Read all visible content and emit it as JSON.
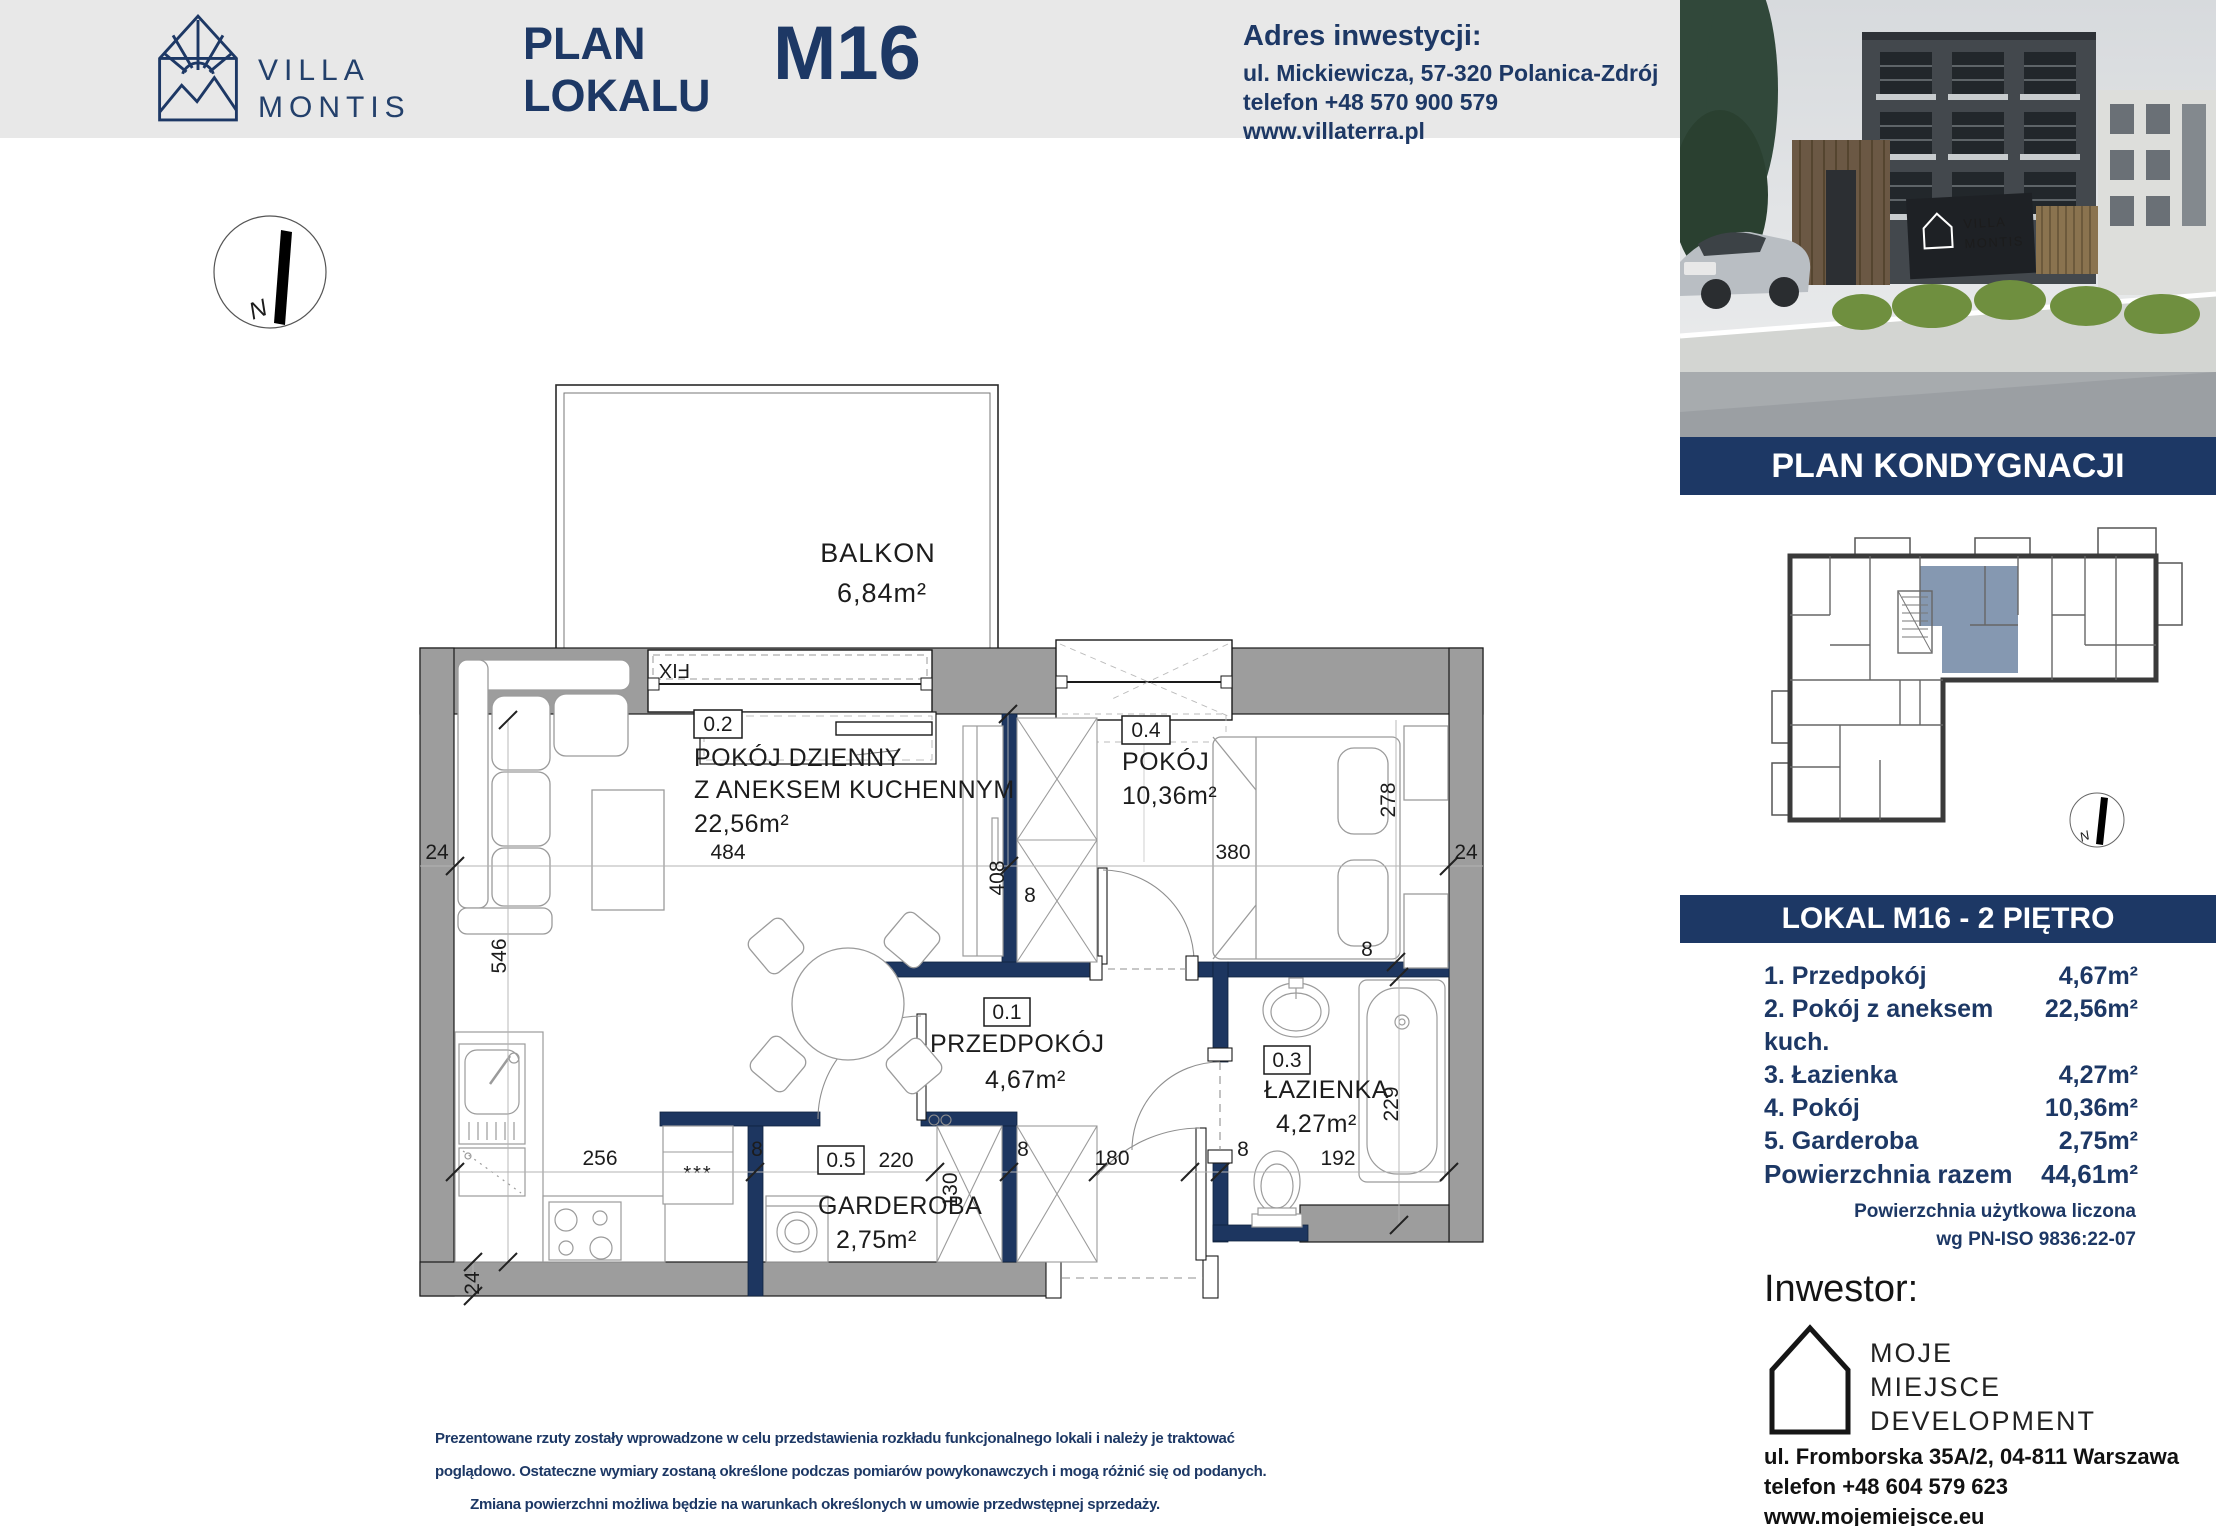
{
  "colors": {
    "navy": "#1d3865",
    "wall_gray": "#9d9d9d",
    "unit_highlight": "#8598b1"
  },
  "header": {
    "brand_line1": "VILLA",
    "brand_line2": "MONTIS",
    "title_line1": "PLAN",
    "title_line2": "LOKALU",
    "unit_code": "M16",
    "address_heading": "Adres inwestycji:",
    "address_street": "ul. Mickiewicza, 57-320 Polanica-Zdrój",
    "address_phone": "telefon +48 570 900 579",
    "address_web": "www.villaterra.pl"
  },
  "plan": {
    "compass_label": "N",
    "balcony_name": "BALKON",
    "balcony_area": "6,84m²",
    "window_fix": "FIX",
    "fridge_mark": "***",
    "rooms": {
      "living": {
        "id": "0.2",
        "line1": "POKÓJ DZIENNY",
        "line2": "Z ANEKSEM KUCHENNYM",
        "area": "22,56m²"
      },
      "bedroom": {
        "id": "0.4",
        "name": "POKÓJ",
        "area": "10,36m²"
      },
      "hall": {
        "id": "0.1",
        "name": "PRZEDPOKÓJ",
        "area": "4,67m²"
      },
      "bath": {
        "id": "0.3",
        "name": "ŁAZIENKA",
        "area": "4,27m²"
      },
      "wardrobe": {
        "id": "0.5",
        "name": "GARDEROBA",
        "area": "2,75m²"
      }
    },
    "dims": {
      "wall24": "24",
      "living_w": "484",
      "bedroom_w": "380",
      "living_h": "546",
      "hall_h": "408",
      "t8": "8",
      "bed_d": "278",
      "bath_h": "229",
      "kitchen_w": "256",
      "wardrobe_w": "220",
      "wardrobe_h": "130",
      "hall_w": "180",
      "bath_w": "192"
    }
  },
  "sidebar": {
    "photo": {
      "sign_line1": "VILLA",
      "sign_line2": "MONTIS"
    },
    "banner_top": "PLAN KONDYGNACJI",
    "banner_unit": "LOKAL M16 - 2 PIĘTRO",
    "rooms": [
      {
        "label": "1. Przedpokój",
        "value": "4,67m²"
      },
      {
        "label": "2. Pokój z aneksem kuch.",
        "value": "22,56m²"
      },
      {
        "label": "3. Łazienka",
        "value": "4,27m²"
      },
      {
        "label": "4. Pokój",
        "value": "10,36m²"
      },
      {
        "label": "5. Garderoba",
        "value": "2,75m²"
      }
    ],
    "total_label": "Powierzchnia razem",
    "total_value": "44,61m²",
    "note_line1": "Powierzchnia użytkowa liczona",
    "note_line2": "wg PN-ISO 9836:22-07",
    "investor_heading": "Inwestor:",
    "investor_line1": "MOJE",
    "investor_line2": "MIEJSCE",
    "investor_line3": "DEVELOPMENT",
    "investor_address": "ul. Fromborska 35A/2, 04-811 Warszawa",
    "investor_phone": "telefon +48 604 579 623",
    "investor_web": "www.mojemiejsce.eu"
  },
  "footer": {
    "line1": "Prezentowane rzuty zostały wprowadzone w celu przedstawienia rozkładu funkcjonalnego lokali i należy je traktować",
    "line2": "poglądowo. Ostateczne wymiary zostaną określone podczas pomiarów powykonawczych i mogą różnić się od podanych.",
    "line3": "Zmiana powierzchni możliwa będzie na warunkach określonych w umowie przedwstępnej sprzedaży."
  }
}
